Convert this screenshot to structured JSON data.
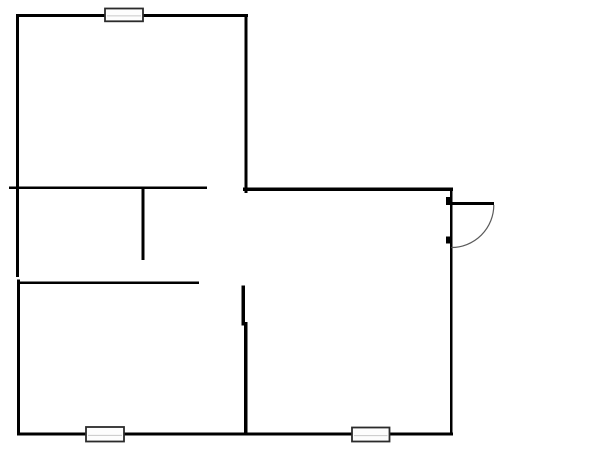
{
  "document": {
    "type": "floor-plan",
    "canvas_width": 600,
    "canvas_height": 471,
    "background": "#ffffff"
  },
  "style": {
    "wall_color": "#000000",
    "door_color": "#000000",
    "door_arc_color": "#5a5a5a",
    "door_arc_width": 1.2,
    "window_border_color": "#2b2b2b",
    "window_fill": "#fdfdfd",
    "window_mullion_color": "#c8c8c8"
  },
  "walls": [
    {
      "name": "top-wall",
      "x": 16,
      "y": 14,
      "w": 232,
      "h": 3.2
    },
    {
      "name": "left-wall-upper",
      "x": 16,
      "y": 14,
      "w": 3,
      "h": 263
    },
    {
      "name": "left-wall-lower",
      "x": 17,
      "y": 279.5,
      "w": 3,
      "h": 155.5
    },
    {
      "name": "bottom-wall",
      "x": 17,
      "y": 432.5,
      "w": 436,
      "h": 3
    },
    {
      "name": "room1-right-wall",
      "x": 244.5,
      "y": 15,
      "w": 2.8,
      "h": 178
    },
    {
      "name": "upper-right-wall",
      "x": 243,
      "y": 187.5,
      "w": 210,
      "h": 3.4
    },
    {
      "name": "right-wall",
      "x": 450,
      "y": 190,
      "w": 2.4,
      "h": 245
    },
    {
      "name": "interior-wall-a",
      "x": 9,
      "y": 186.5,
      "w": 198,
      "h": 2.6
    },
    {
      "name": "interior-wall-b",
      "x": 141.7,
      "y": 189,
      "w": 2.9,
      "h": 71
    },
    {
      "name": "interior-wall-c",
      "x": 18,
      "y": 281.5,
      "w": 181,
      "h": 2.6
    },
    {
      "name": "interior-wall-d-upper",
      "x": 241.7,
      "y": 285.5,
      "w": 3.4,
      "h": 40
    },
    {
      "name": "interior-wall-d-lower",
      "x": 244.2,
      "y": 322,
      "w": 3.2,
      "h": 113
    }
  ],
  "windows": [
    {
      "name": "top-window",
      "x": 105,
      "y": 8.5,
      "w": 38,
      "h": 12.8
    },
    {
      "name": "bottom-left-window",
      "x": 86,
      "y": 427,
      "w": 38,
      "h": 14.5
    },
    {
      "name": "bottom-right-window",
      "x": 352,
      "y": 427.5,
      "w": 37.5,
      "h": 14
    }
  ],
  "door": {
    "name": "right-entry-door",
    "jambs": [
      {
        "name": "door-jamb-top",
        "x": 445.8,
        "y": 197,
        "w": 5.4,
        "h": 8
      },
      {
        "name": "door-jamb-bottom",
        "x": 446,
        "y": 236.5,
        "w": 5,
        "h": 7
      }
    ],
    "leaf": {
      "name": "door-leaf",
      "x": 450.5,
      "y": 201.8,
      "w": 43.5,
      "h": 3.2
    },
    "arc": {
      "name": "door-swing-arc",
      "cx": 451.3,
      "cy": 205,
      "r": 42.5
    }
  }
}
